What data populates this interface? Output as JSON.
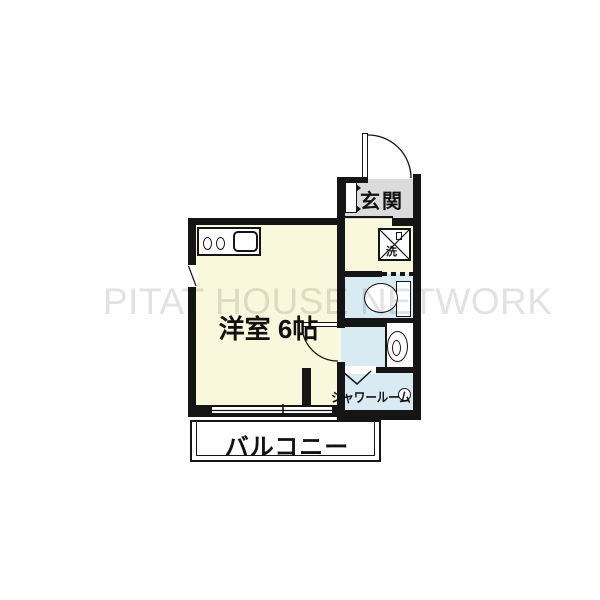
{
  "watermark": "PITAT HOUSE NETWORK",
  "rooms": {
    "genkan": {
      "label": "玄関"
    },
    "main": {
      "label": "洋室 6帖"
    },
    "shower": {
      "label": "シャワールーム"
    },
    "balcony": {
      "label": "バルコニー"
    },
    "laundry": {
      "label": "洗"
    }
  },
  "colors": {
    "cream": "#FAF8DC",
    "gray": "#DBDBDB",
    "blue": "#D9EBF2",
    "wall": "#151515",
    "watermark": "#E2E2E2"
  }
}
